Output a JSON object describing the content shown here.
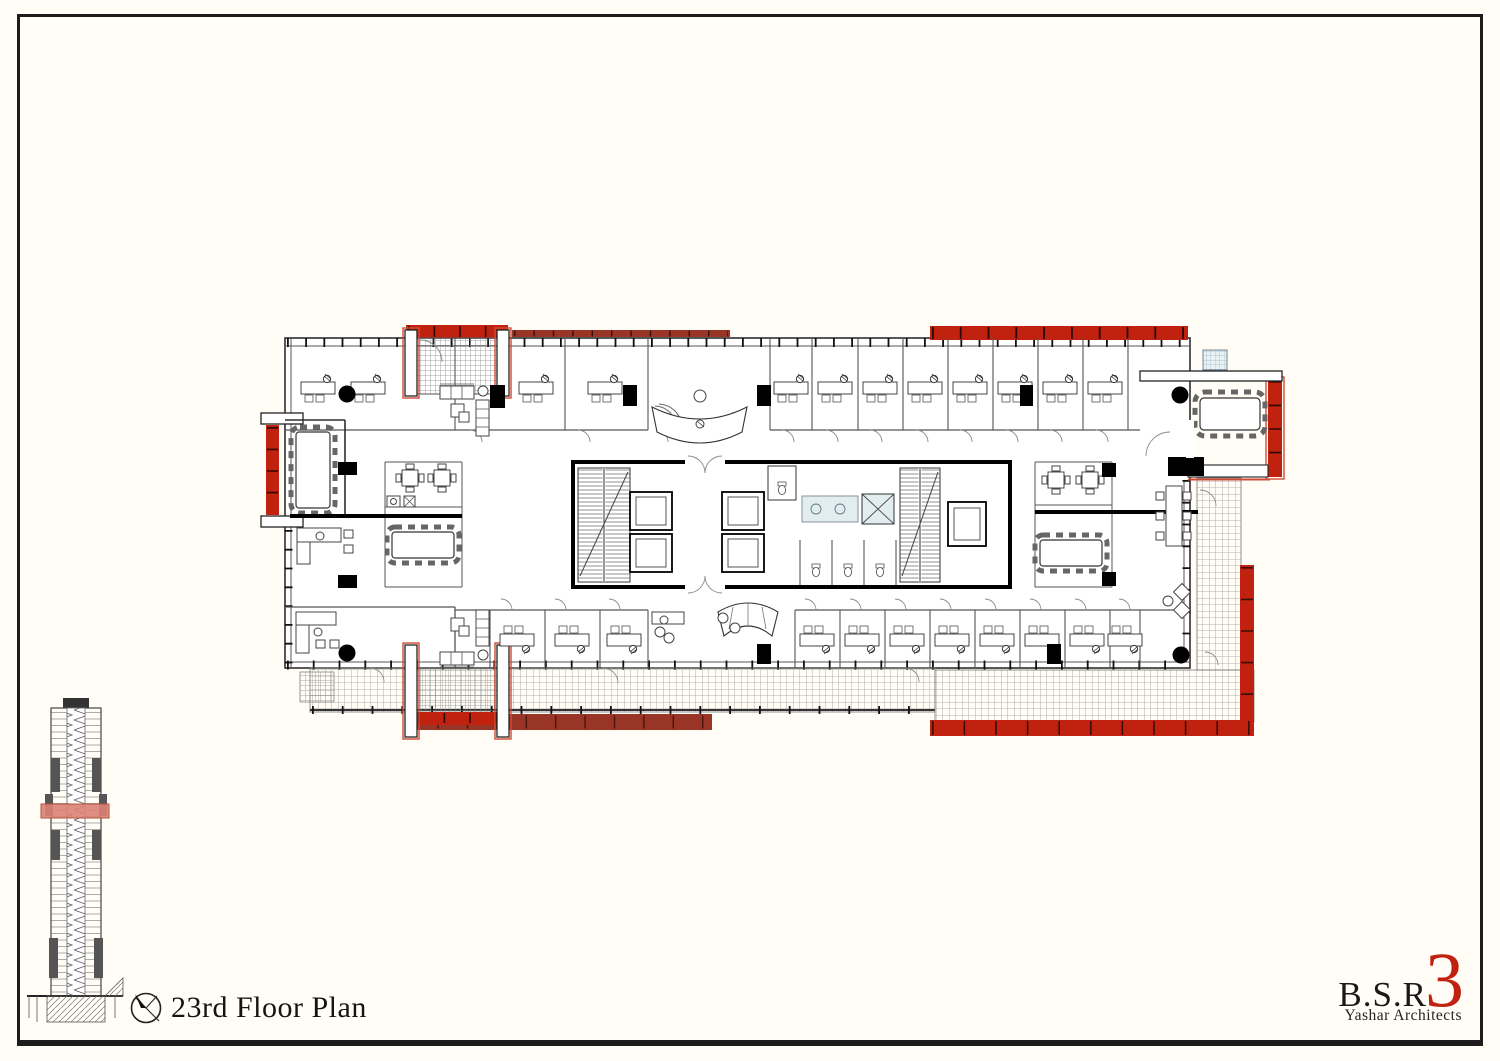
{
  "sheet": {
    "title": "23rd Floor Plan",
    "title_icon": "north-arrow-compass",
    "logo": {
      "firm": "B.S.R",
      "mark": "3",
      "tagline": "Yashar Architects"
    },
    "colors": {
      "paper": "#fffdf6",
      "frame": "#1d1d1d",
      "ink": "#2e2e2e",
      "accent_red": "#c1220f",
      "brick_red": "#993526",
      "section_highlight": "#dd8274",
      "hatch_line": "#9a9a9a",
      "aqua": "#dde9ec"
    }
  }
}
